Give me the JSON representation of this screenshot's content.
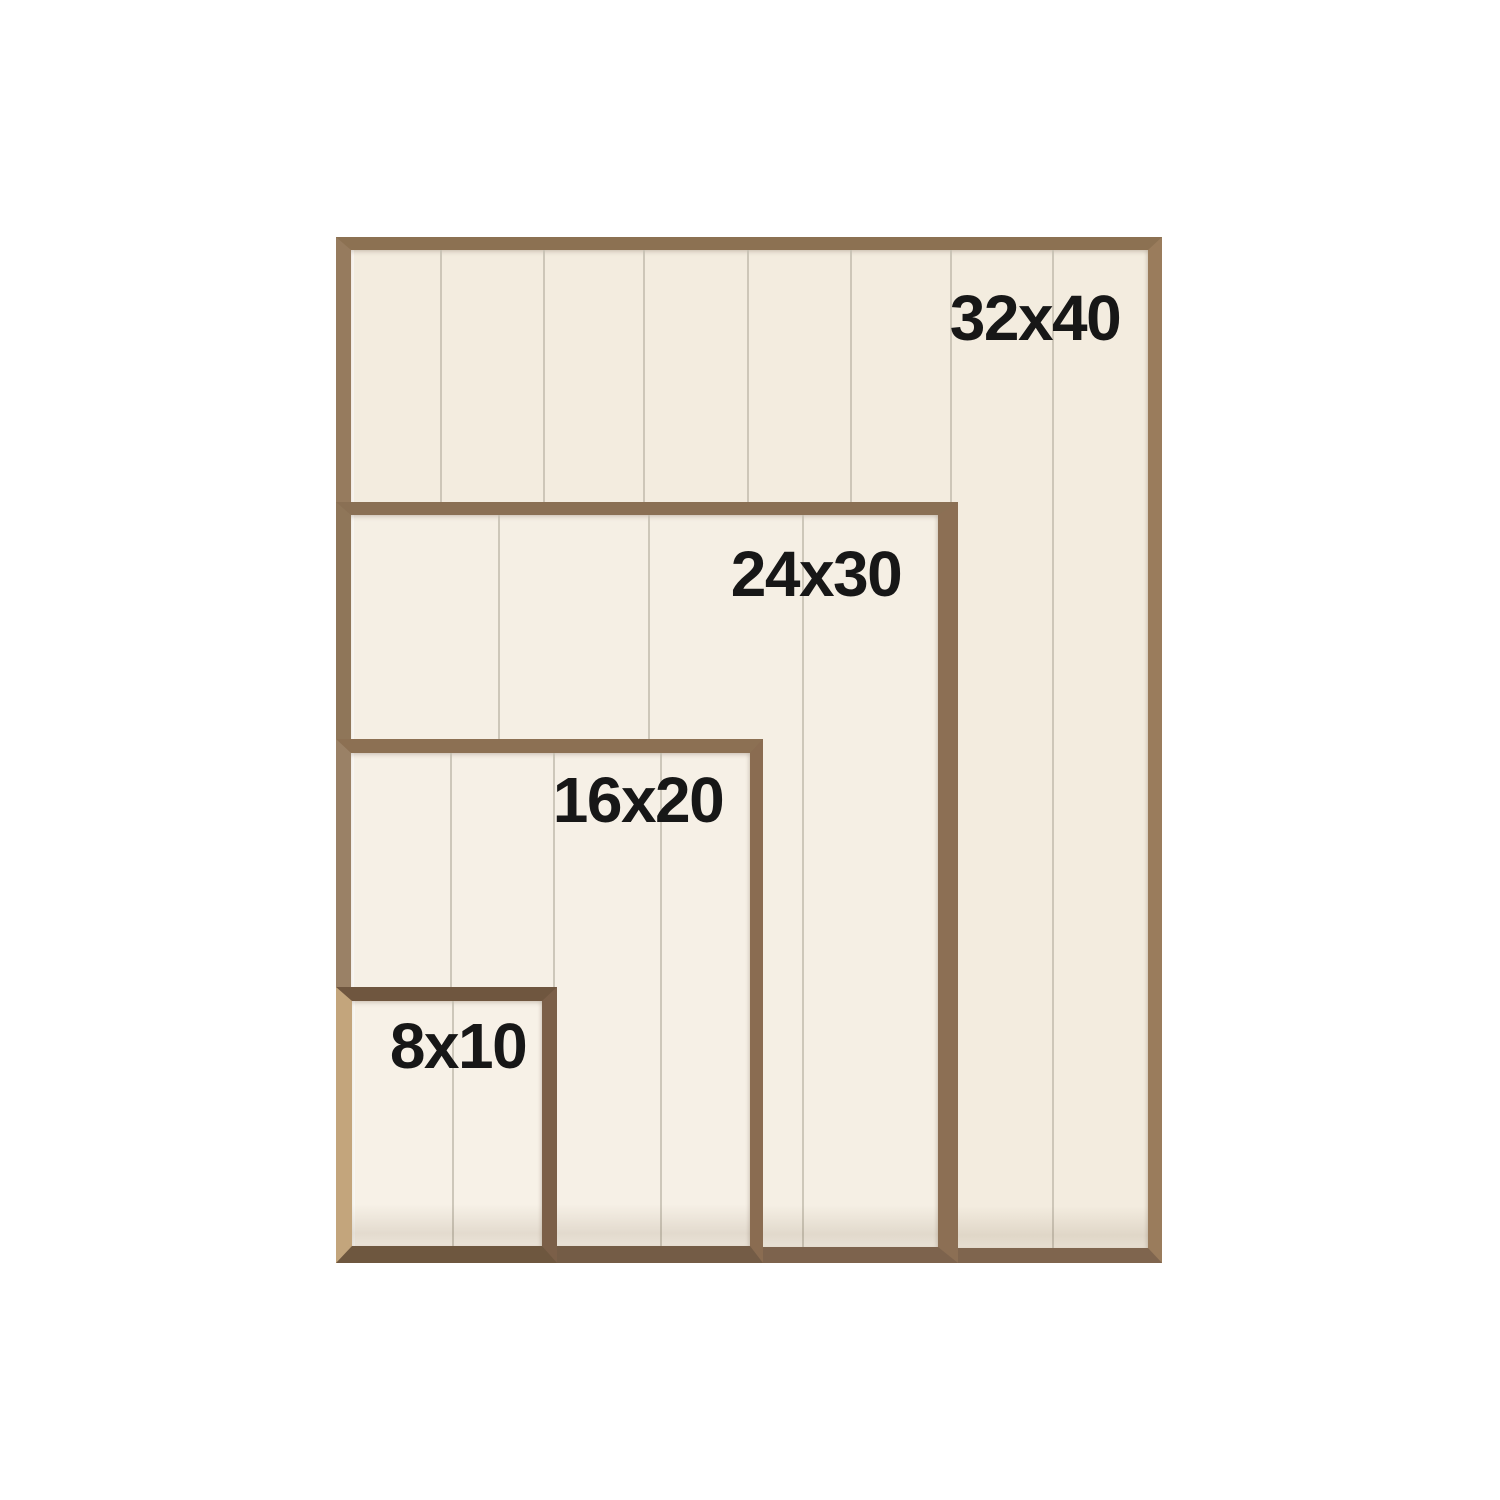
{
  "meta": {
    "description": "Wood frame size comparison diagram with four nested shiplap-backed frames sharing a common bottom-left corner",
    "background_color": "#ffffff",
    "label_text_color": "#171717",
    "plank_line_color": "#c6bfb1"
  },
  "sizes": [
    {
      "label": "32x40",
      "width_in": 32,
      "height_in": 40
    },
    {
      "label": "24x30",
      "width_in": 24,
      "height_in": 30
    },
    {
      "label": "16x20",
      "width_in": 16,
      "height_in": 20
    },
    {
      "label": "8x10",
      "width_in": 8,
      "height_in": 10
    }
  ],
  "frames": [
    {
      "label": "32x40",
      "x": 336,
      "y": 237,
      "w": 826,
      "h": 1026,
      "border": {
        "top": 13,
        "right": 14,
        "bottom": 15,
        "left": 15
      },
      "wood": {
        "top": "#8c7152",
        "right": "#9a7c5c",
        "bottom": "#7f654e",
        "left": "#967b5e"
      },
      "interior_color": "#f3ecdf",
      "plank_lines_x": [
        89,
        192,
        292,
        396,
        499,
        599,
        701
      ],
      "label_pos": {
        "cx": 684,
        "cy": 68
      }
    },
    {
      "label": "24x30",
      "x": 336,
      "y": 502,
      "w": 622,
      "h": 761,
      "border": {
        "top": 13,
        "right": 20,
        "bottom": 16,
        "left": 15
      },
      "wood": {
        "top": "#8a7054",
        "right": "#8c6f54",
        "bottom": "#7d634d",
        "left": "#8f7659"
      },
      "interior_color": "#f5efe4",
      "plank_lines_x": [
        147,
        297,
        451
      ],
      "label_pos": {
        "cx": 465,
        "cy": 59
      }
    },
    {
      "label": "16x20",
      "x": 336,
      "y": 739,
      "w": 427,
      "h": 524,
      "border": {
        "top": 14,
        "right": 13,
        "bottom": 17,
        "left": 15
      },
      "wood": {
        "top": "#8c7053",
        "right": "#8a6c51",
        "bottom": "#745c46",
        "left": "#9a8166"
      },
      "interior_color": "#f6f0e6",
      "plank_lines_x": [
        99,
        202,
        309
      ],
      "label_pos": {
        "cx": 287,
        "cy": 47
      }
    },
    {
      "label": "8x10",
      "x": 336,
      "y": 987,
      "w": 221,
      "h": 276,
      "border": {
        "top": 14,
        "right": 15,
        "bottom": 17,
        "left": 16
      },
      "wood": {
        "top": "#6f563f",
        "right": "#7b5f48",
        "bottom": "#6e573f",
        "left": "#c3a57c"
      },
      "interior_color": "#f7f1e7",
      "plank_lines_x": [
        100
      ],
      "label_pos": {
        "cx": 106,
        "cy": 45
      }
    }
  ]
}
